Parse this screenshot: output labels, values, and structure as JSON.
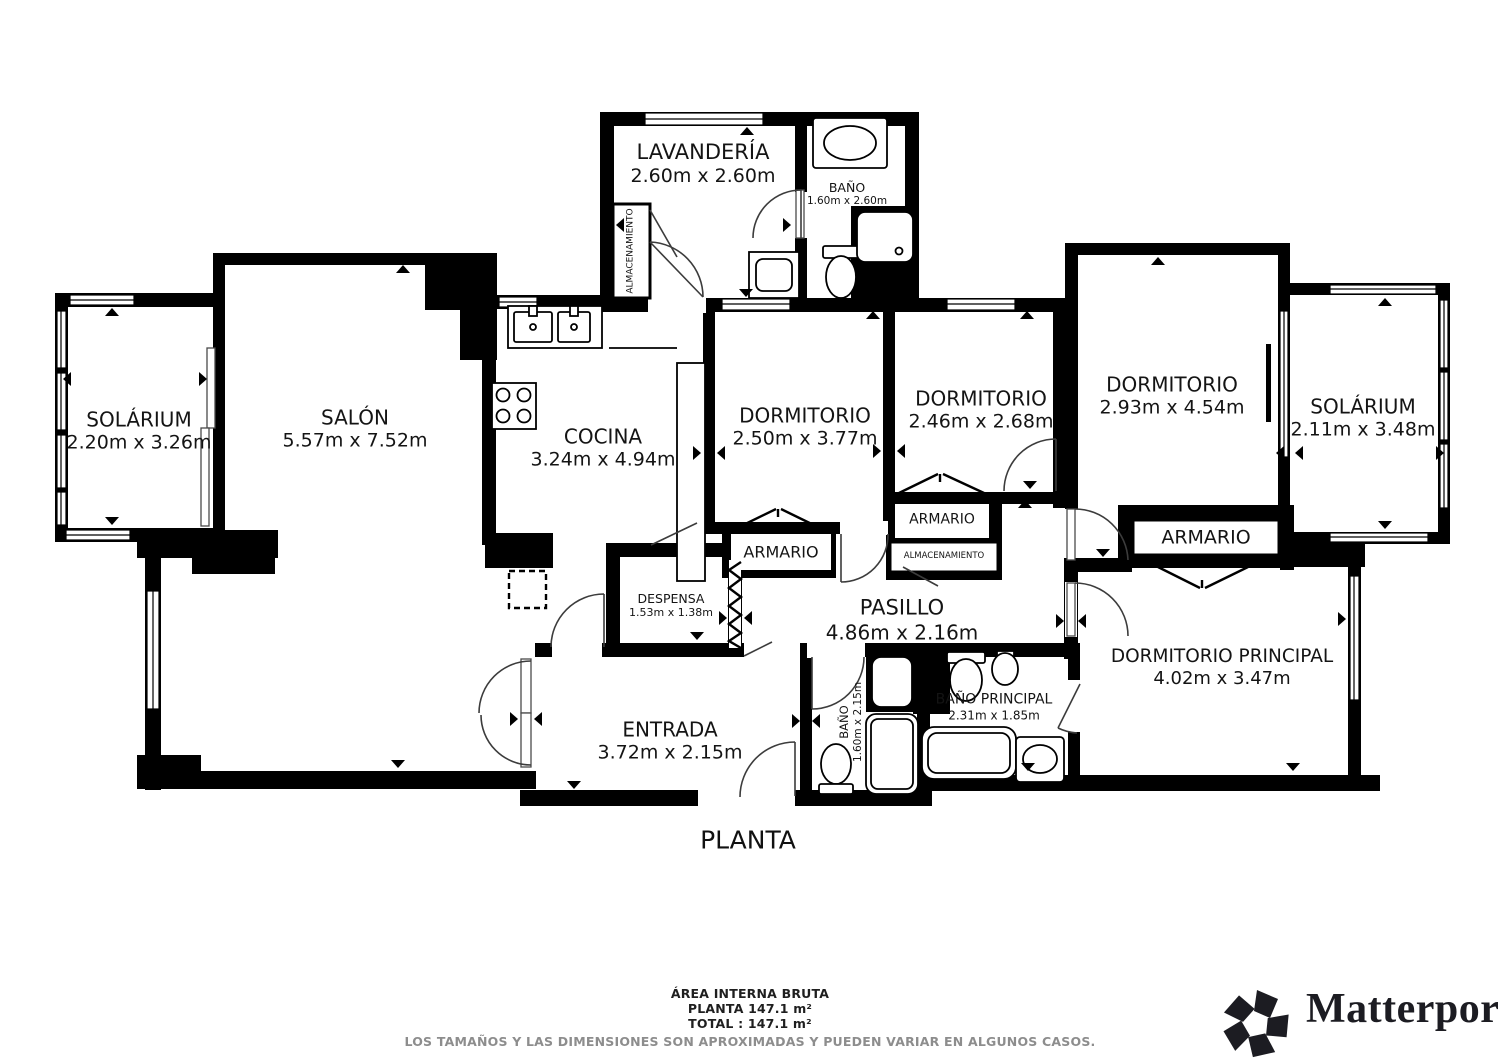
{
  "plan": {
    "title": "PLANTA",
    "rooms": {
      "lavanderia": {
        "name": "LAVANDERÍA",
        "dims": "2.60m x 2.60m"
      },
      "bano_top": {
        "name": "BAÑO",
        "dims": "1.60m x 2.60m"
      },
      "almacenamiento_lavanderia": {
        "name": "ALMACENAMIENTO"
      },
      "solarium_izq": {
        "name": "SOLÁRIUM",
        "dims": "2.20m x 3.26m"
      },
      "salon": {
        "name": "SALÓN",
        "dims": "5.57m x 7.52m"
      },
      "cocina": {
        "name": "COCINA",
        "dims": "3.24m x 4.94m"
      },
      "dormitorio_1": {
        "name": "DORMITORIO",
        "dims": "2.50m x 3.77m"
      },
      "dormitorio_2": {
        "name": "DORMITORIO",
        "dims": "2.46m x 2.68m"
      },
      "dormitorio_3": {
        "name": "DORMITORIO",
        "dims": "2.93m x 4.54m"
      },
      "solarium_der": {
        "name": "SOLÁRIUM",
        "dims": "2.11m x 3.48m"
      },
      "armario_1": {
        "name": "ARMARIO"
      },
      "armario_2": {
        "name": "ARMARIO"
      },
      "almacenamiento_pasillo": {
        "name": "ALMACENAMIENTO"
      },
      "armario_3": {
        "name": "ARMARIO"
      },
      "despensa": {
        "name": "DESPENSA",
        "dims": "1.53m x 1.38m"
      },
      "pasillo": {
        "name": "PASILLO",
        "dims": "4.86m x 2.16m"
      },
      "entrada": {
        "name": "ENTRADA",
        "dims": "3.72m x 2.15m"
      },
      "bano_pasillo": {
        "name": "BAÑO",
        "dims": "1.60m x 2.15m"
      },
      "bano_principal": {
        "name": "BAÑO PRINCIPAL",
        "dims": "2.31m x 1.85m"
      },
      "dormitorio_principal": {
        "name": "DORMITORIO PRINCIPAL",
        "dims": "4.02m x 3.47m"
      }
    }
  },
  "footer": {
    "line1": "ÁREA INTERNA BRUTA",
    "line2": "PLANTA 147.1 m²",
    "line3": "TOTAL :  147.1 m²",
    "disclaimer": "LOS TAMAÑOS Y LAS DIMENSIONES SON APROXIMADAS Y PUEDEN VARIAR EN ALGUNOS CASOS."
  },
  "branding": {
    "logo_text": "Matterport",
    "registered_mark": "®"
  },
  "colors": {
    "walls": "#000000",
    "background": "#ffffff",
    "door_arc": "#3c3c3c",
    "disclaimer_text": "#8d8d8d",
    "logo_text": "#1c1c22"
  }
}
